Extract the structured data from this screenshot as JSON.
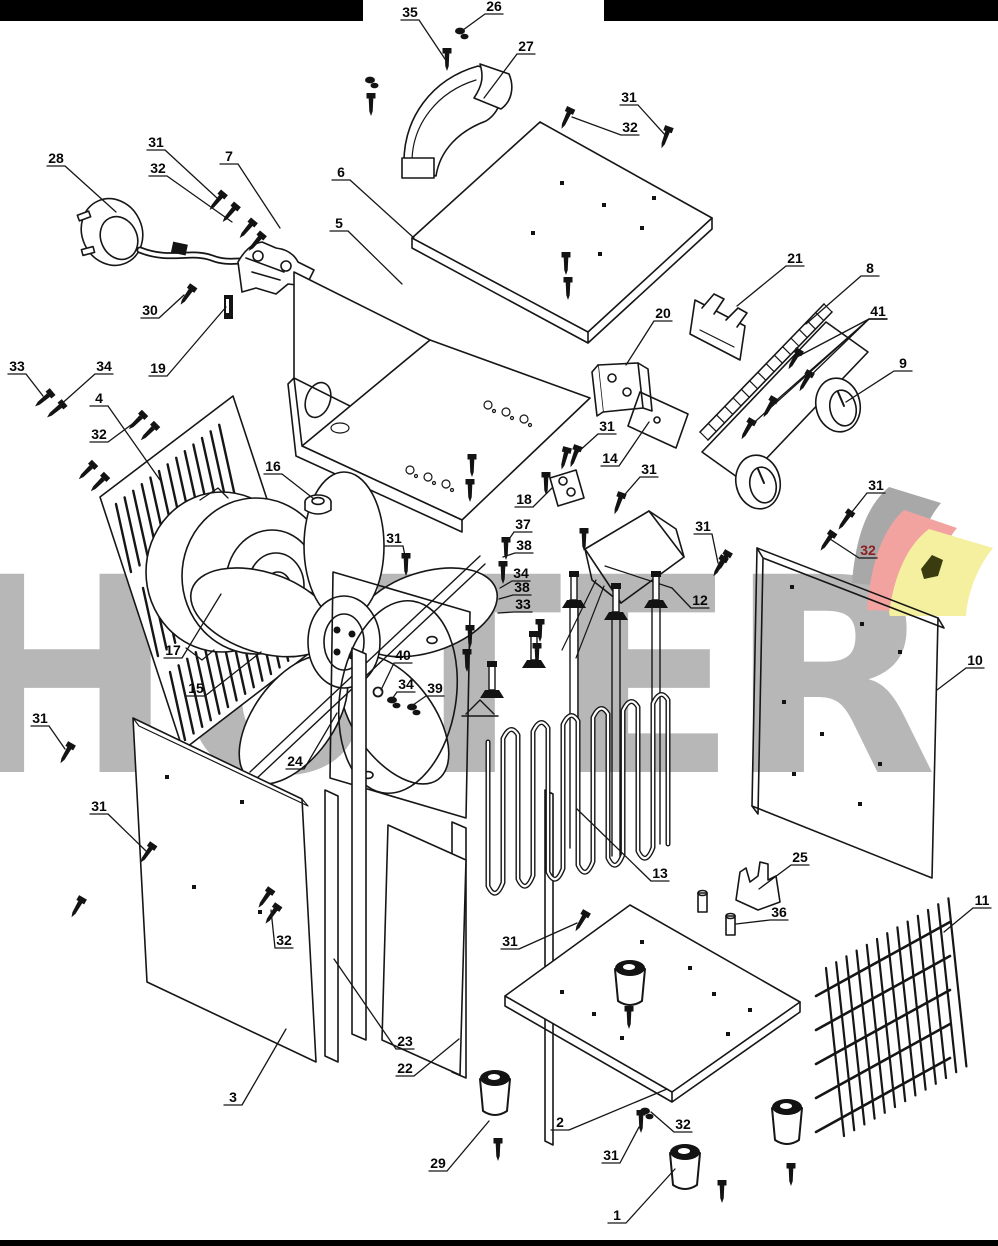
{
  "page": {
    "width": 998,
    "height": 1246,
    "background": "#ffffff"
  },
  "bars": {
    "color": "#000000"
  },
  "watermark": {
    "text": "HÜTER",
    "color": "#b7b7b7"
  },
  "logo": {
    "name": "huter-swoosh",
    "sail_colors": {
      "back": "#a8a8a8",
      "middle": "#f2a3a0",
      "front": "#f4f0a0"
    },
    "blob_color": "#3b3b10"
  },
  "diagram": {
    "stroke_color": "#161616",
    "label_color": "#070707",
    "red_label_color": "#8b1e1e",
    "callouts": [
      {
        "n": "35",
        "x": 410,
        "y": 12,
        "tx": 447,
        "ty": 62
      },
      {
        "n": "26",
        "x": 494,
        "y": 6,
        "tx": 463,
        "ty": 30
      },
      {
        "n": "27",
        "x": 526,
        "y": 46,
        "tx": 484,
        "ty": 98
      },
      {
        "n": "31",
        "x": 629,
        "y": 97,
        "tx": 666,
        "ty": 136
      },
      {
        "n": "32",
        "x": 630,
        "y": 127,
        "tx": 572,
        "ty": 117
      },
      {
        "n": "28",
        "x": 56,
        "y": 158,
        "tx": 116,
        "ty": 212
      },
      {
        "n": "31",
        "x": 156,
        "y": 142,
        "tx": 217,
        "ty": 198
      },
      {
        "n": "32",
        "x": 158,
        "y": 168,
        "tx": 232,
        "ty": 222
      },
      {
        "n": "7",
        "x": 229,
        "y": 156,
        "tx": 280,
        "ty": 228
      },
      {
        "n": "6",
        "x": 341,
        "y": 172,
        "tx": 414,
        "ty": 238
      },
      {
        "n": "5",
        "x": 339,
        "y": 223,
        "tx": 402,
        "ty": 284
      },
      {
        "n": "30",
        "x": 150,
        "y": 310,
        "tx": 184,
        "ty": 295
      },
      {
        "n": "19",
        "x": 158,
        "y": 368,
        "tx": 226,
        "ty": 307
      },
      {
        "n": "33",
        "x": 17,
        "y": 366,
        "tx": 43,
        "ty": 396
      },
      {
        "n": "34",
        "x": 104,
        "y": 366,
        "tx": 58,
        "ty": 407
      },
      {
        "n": "4",
        "x": 99,
        "y": 398,
        "tx": 160,
        "ty": 480
      },
      {
        "n": "32",
        "x": 99,
        "y": 434,
        "tx": 135,
        "ty": 422
      },
      {
        "n": "21",
        "x": 795,
        "y": 258,
        "tx": 737,
        "ty": 306
      },
      {
        "n": "8",
        "x": 870,
        "y": 268,
        "tx": 806,
        "ty": 324
      },
      {
        "n": "41",
        "x": 878,
        "y": 311,
        "targets": [
          [
            795,
            358
          ],
          [
            806,
            380
          ],
          [
            770,
            406
          ],
          [
            748,
            428
          ]
        ]
      },
      {
        "n": "9",
        "x": 903,
        "y": 363,
        "tx": 846,
        "ty": 402
      },
      {
        "n": "20",
        "x": 663,
        "y": 313,
        "tx": 626,
        "ty": 365
      },
      {
        "n": "31",
        "x": 607,
        "y": 426,
        "tx": 577,
        "ty": 453
      },
      {
        "n": "14",
        "x": 610,
        "y": 458,
        "tx": 649,
        "ty": 422
      },
      {
        "n": "31",
        "x": 649,
        "y": 469,
        "tx": 620,
        "ty": 500
      },
      {
        "n": "16",
        "x": 273,
        "y": 466,
        "tx": 314,
        "ty": 499
      },
      {
        "n": "18",
        "x": 524,
        "y": 499,
        "tx": 552,
        "ty": 488
      },
      {
        "n": "37",
        "x": 523,
        "y": 524,
        "tx": 505,
        "ty": 545
      },
      {
        "n": "38",
        "x": 524,
        "y": 545,
        "tx": 503,
        "ty": 557
      },
      {
        "n": "34",
        "x": 521,
        "y": 573,
        "tx": 500,
        "ty": 588
      },
      {
        "n": "38",
        "x": 522,
        "y": 587,
        "tx": 499,
        "ty": 599
      },
      {
        "n": "33",
        "x": 523,
        "y": 604,
        "tx": 498,
        "ty": 613
      },
      {
        "n": "31",
        "x": 703,
        "y": 526,
        "tx": 718,
        "ty": 563
      },
      {
        "n": "31",
        "x": 876,
        "y": 485,
        "tx": 848,
        "ty": 517
      },
      {
        "n": "32",
        "x": 868,
        "y": 550,
        "tx": 830,
        "ty": 539,
        "red": true
      },
      {
        "n": "12",
        "x": 700,
        "y": 600,
        "tx": 672,
        "ty": 588
      },
      {
        "n": "10",
        "x": 975,
        "y": 660,
        "tx": 937,
        "ty": 690
      },
      {
        "n": "31",
        "x": 394,
        "y": 538,
        "tx": 406,
        "ty": 561
      },
      {
        "n": "17",
        "x": 173,
        "y": 650,
        "tx": 221,
        "ty": 594
      },
      {
        "n": "15",
        "x": 196,
        "y": 688,
        "tx": 261,
        "ty": 652
      },
      {
        "n": "40",
        "x": 403,
        "y": 655,
        "tx": 381,
        "ty": 690
      },
      {
        "n": "34",
        "x": 406,
        "y": 684,
        "tx": 392,
        "ty": 699
      },
      {
        "n": "39",
        "x": 435,
        "y": 688,
        "tx": 413,
        "ty": 705
      },
      {
        "n": "24",
        "x": 295,
        "y": 761,
        "tx": 337,
        "ty": 713
      },
      {
        "n": "31",
        "x": 40,
        "y": 718,
        "tx": 65,
        "ty": 749
      },
      {
        "n": "31",
        "x": 99,
        "y": 806,
        "tx": 146,
        "ty": 851
      },
      {
        "n": "32",
        "x": 284,
        "y": 940,
        "tx": 271,
        "ty": 910
      },
      {
        "n": "23",
        "x": 405,
        "y": 1041,
        "tx": 334,
        "ty": 959
      },
      {
        "n": "22",
        "x": 405,
        "y": 1068,
        "tx": 459,
        "ty": 1039
      },
      {
        "n": "3",
        "x": 233,
        "y": 1097,
        "tx": 286,
        "ty": 1029
      },
      {
        "n": "13",
        "x": 660,
        "y": 873,
        "tx": 577,
        "ty": 809
      },
      {
        "n": "25",
        "x": 800,
        "y": 857,
        "tx": 759,
        "ty": 889
      },
      {
        "n": "36",
        "x": 779,
        "y": 912,
        "tx": 736,
        "ty": 924
      },
      {
        "n": "11",
        "x": 982,
        "y": 900,
        "tx": 944,
        "ty": 932
      },
      {
        "n": "31",
        "x": 510,
        "y": 941,
        "tx": 577,
        "ty": 923
      },
      {
        "n": "29",
        "x": 438,
        "y": 1163,
        "tx": 489,
        "ty": 1121
      },
      {
        "n": "2",
        "x": 560,
        "y": 1122,
        "tx": 667,
        "ty": 1089
      },
      {
        "n": "31",
        "x": 611,
        "y": 1155,
        "tx": 639,
        "ty": 1127
      },
      {
        "n": "32",
        "x": 683,
        "y": 1124,
        "tx": 651,
        "ty": 1112
      },
      {
        "n": "1",
        "x": 617,
        "y": 1215,
        "tx": 675,
        "ty": 1169
      }
    ]
  }
}
